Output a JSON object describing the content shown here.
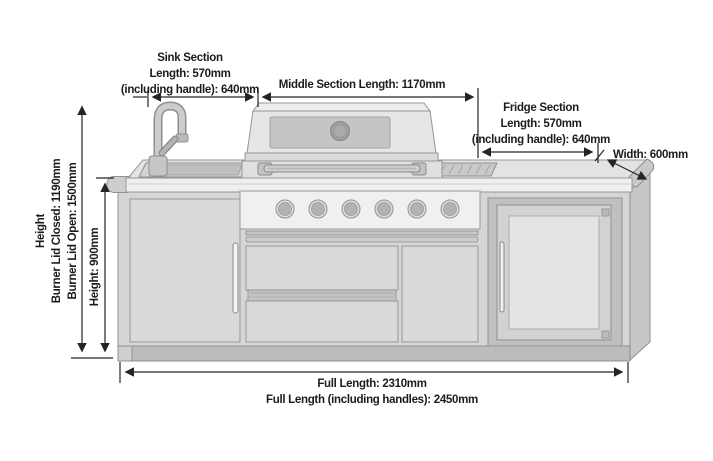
{
  "labels": {
    "sink_section": {
      "title": "Sink Section",
      "length": "Length: 570mm",
      "including_handle": "(including handle): 640mm"
    },
    "middle_section": {
      "length": "Middle Section Length: 1170mm"
    },
    "fridge_section": {
      "title": "Fridge Section",
      "length": "Length: 570mm",
      "including_handle": "(including handle): 640mm"
    },
    "width": "Width: 600mm",
    "height": {
      "title": "Height",
      "burner_lid_closed": "Burner Lid Closed: 1190mm",
      "burner_lid_open": "Burner Lid Open: 1500mm",
      "cabinet": "Height: 900mm"
    },
    "full_length": {
      "line1": "Full Length: 2310mm",
      "line2": "Full Length (including handles): 2450mm"
    }
  },
  "measurements": [
    {
      "name": "Sink Section Length",
      "value": "570mm"
    },
    {
      "name": "Sink Section Length (including handle)",
      "value": "640mm"
    },
    {
      "name": "Middle Section Length",
      "value": "1170mm"
    },
    {
      "name": "Fridge Section Length",
      "value": "570mm"
    },
    {
      "name": "Fridge Section Length (including handle)",
      "value": "640mm"
    },
    {
      "name": "Width",
      "value": "600mm"
    },
    {
      "name": "Height (Burner Lid Closed)",
      "value": "1190mm"
    },
    {
      "name": "Height (Burner Lid Open)",
      "value": "1500mm"
    },
    {
      "name": "Cabinet Height",
      "value": "900mm"
    },
    {
      "name": "Full Length",
      "value": "2310mm"
    },
    {
      "name": "Full Length (including handles)",
      "value": "2450mm"
    }
  ],
  "colors": {
    "background": "#ffffff",
    "dimension_line": "#242424",
    "label_text": "#1c1c1c",
    "body_fill": "#d6d6d6",
    "panel_light": "#efefef",
    "plinth": "#bcbcbc",
    "outline": "#8f8f8f"
  }
}
